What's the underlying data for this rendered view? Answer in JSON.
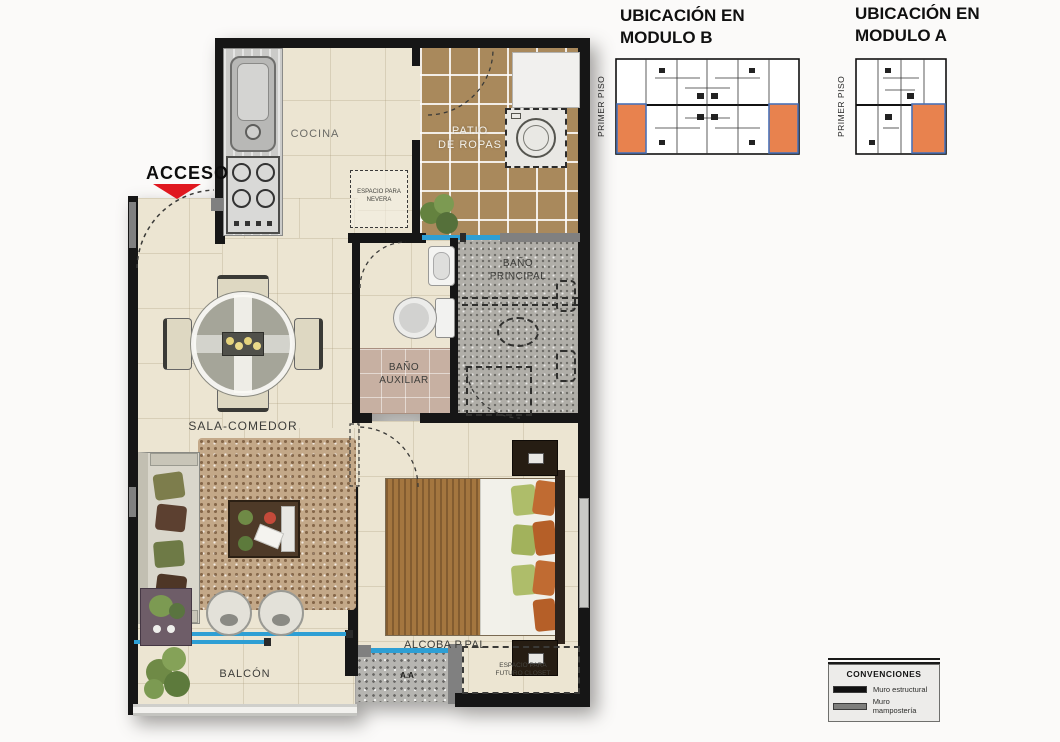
{
  "plan": {
    "acceso": "ACCESO",
    "cocina": "COCINA",
    "nevera": "ESPACIO PARA\nNEVERA",
    "patio": "PATIO\nDE ROPAS",
    "banio_principal": "BAÑO\nPRINCIPAL",
    "banio_auxiliar": "BAÑO\nAUXILIAR",
    "sala_comedor": "SALA-COMEDOR",
    "alcoba_ppal": "ALCOBA P.PAL",
    "balcon": "BALCÓN",
    "aire_acondicionado": "A.A",
    "futuro_closet": "ESPACIO PARA\nFUTURO CLOSET"
  },
  "location_keys": {
    "module_b": {
      "title": "UBICACIÓN EN\nMODULO B",
      "floor": "PRIMER PISO"
    },
    "module_a": {
      "title": "UBICACIÓN EN\nMODULO A",
      "floor": "PRIMER PISO"
    }
  },
  "legend": {
    "title": "CONVENCIONES",
    "items": [
      {
        "label": "Muro estructural",
        "color": "#101010"
      },
      {
        "label": "Muro mampostería",
        "color": "#7e7e7c"
      }
    ]
  },
  "colors": {
    "accent_red": "#e0181f",
    "unit_highlight": "#e8824e",
    "unit_highlight_border": "#4a72b8",
    "wall_structural": "#161616",
    "wall_masonry": "#808080",
    "window_blue": "#2e9fd4"
  }
}
